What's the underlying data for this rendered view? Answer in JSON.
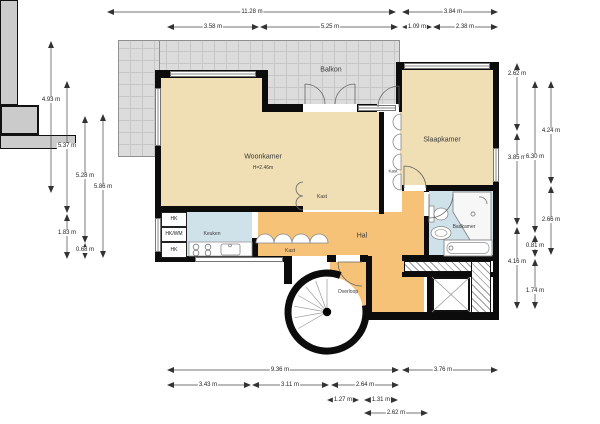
{
  "rooms": {
    "balkon": "Balkon",
    "woonkamer": "Woonkamer",
    "woonkamer_height": "H=2.46m",
    "slaapkamer": "Slaapkamer",
    "badkamer": "Badkamer",
    "keuken": "Keuken",
    "hal": "Hal",
    "overloop": "Overloop",
    "kast_wand": "Kast",
    "kast_box": "Kast",
    "kast_hal": "Kast",
    "hk1": "HK",
    "hk2": "HK/WM",
    "hk3": "HK"
  },
  "dims": {
    "t1": "11.28 m",
    "t2": "3.84 m",
    "t3": "3.58 m",
    "t4": "5.25 m",
    "t5": "1.09 m",
    "t6": "2.38 m",
    "l1": "4.93 m",
    "l2": "5.37 m",
    "l3": "1.83 m",
    "l4": "5.28 m",
    "l5": "0.68 m",
    "l6": "5.86 m",
    "r1": "2.62 m",
    "r2": "3.85 m",
    "r3": "4.16 m",
    "r4": "6.30 m",
    "r5": "0.81 m",
    "r6": "1.74 m",
    "r7": "4.24 m",
    "r8": "2.66 m",
    "b1": "9.36 m",
    "b2": "3.76 m",
    "b3": "3.43 m",
    "b4": "3.11 m",
    "b5": "2.64 m",
    "b6": "1.27 m",
    "b7": "1.31 m",
    "b8": "2.62 m"
  },
  "colors": {
    "floor_living": "#f0deb4",
    "floor_hall": "#f6c277",
    "floor_wet": "#cfe2ea",
    "balcony": "#dcdcdc",
    "closet": "#cbcbcb",
    "wall": "#0c0c0c"
  }
}
